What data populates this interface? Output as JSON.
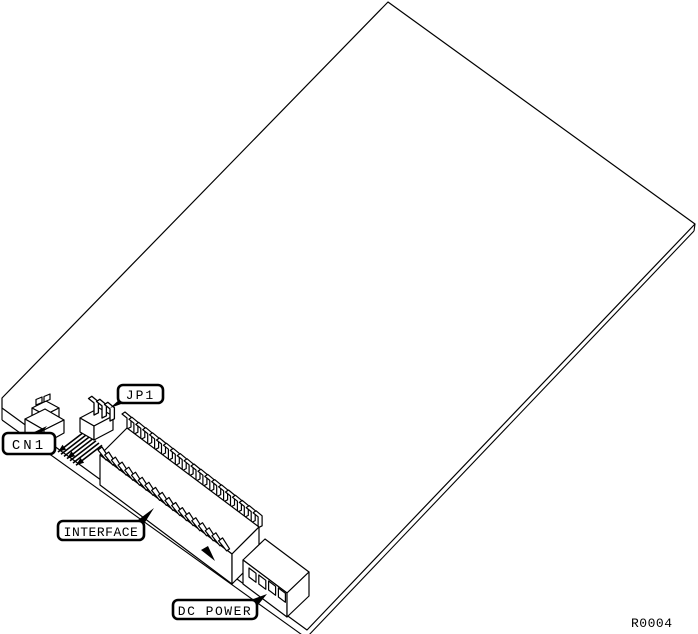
{
  "diagram": {
    "background_color": "#ffffff",
    "line_color": "#000000",
    "callouts": {
      "cn1": "CN1",
      "jp1": "JP1",
      "interface": "INTERFACE",
      "dc_power": "DC POWER"
    },
    "reference": "R0004"
  }
}
